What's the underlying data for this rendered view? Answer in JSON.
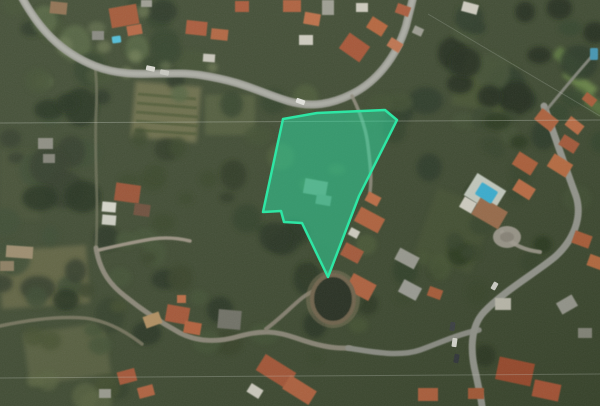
{
  "view": {
    "type": "satellite-map",
    "width": 600,
    "height": 406,
    "base_color": "#39452b",
    "palette": {
      "parcel_fill": "rgba(45,224,164,0.5)",
      "parcel_stroke": "#2ee6a4",
      "road_main": "#9b9c93",
      "road_minor": "#8b8676",
      "roof_terracotta": "#a85331",
      "roof_orange": "#bd6a40",
      "building_white": "#d5d2c5",
      "pool_blue": "#35b2d8",
      "vegetation_dark": "#27331d",
      "field_olive": "#676842"
    },
    "parcel": {
      "points": "283,119 317,113 385,110 397,120 359,196 328,277 302,223 284,222 281,211 263,212",
      "fill": "rgba(45,224,164,0.5)",
      "stroke": "#2ee6a4",
      "stroke_width": 2.5
    },
    "fields": [
      {
        "x": 133,
        "y": 84,
        "w": 66,
        "h": 56,
        "r": 5,
        "c": "#6f7048",
        "o": 0.85
      },
      {
        "x": 205,
        "y": 95,
        "w": 50,
        "h": 40,
        "r": 0,
        "c": "#55603a",
        "o": 0.7
      },
      {
        "x": 0,
        "y": 248,
        "w": 88,
        "h": 58,
        "r": -4,
        "c": "#676842",
        "o": 0.75
      },
      {
        "x": 26,
        "y": 328,
        "w": 82,
        "h": 52,
        "r": -8,
        "c": "#5d6340",
        "o": 0.7
      },
      {
        "x": 0,
        "y": 150,
        "w": 40,
        "h": 70,
        "r": 0,
        "c": "#3f4c2e",
        "o": 0.8
      },
      {
        "x": 424,
        "y": 196,
        "w": 60,
        "h": 70,
        "r": 20,
        "c": "#42502e",
        "o": 0.7
      },
      {
        "x": 455,
        "y": 60,
        "w": 60,
        "h": 50,
        "r": 10,
        "c": "#47552f",
        "o": 0.6
      },
      {
        "x": 552,
        "y": 56,
        "w": 36,
        "h": 12,
        "r": 38,
        "c": "#5d7a3c",
        "o": 0.9
      },
      {
        "x": 562,
        "y": 76,
        "w": 36,
        "h": 12,
        "r": 38,
        "c": "#6d8a46",
        "o": 0.9
      },
      {
        "x": 572,
        "y": 95,
        "w": 36,
        "h": 12,
        "r": 38,
        "c": "#557038",
        "o": 0.9
      }
    ],
    "field_rows": [
      {
        "x1": 138,
        "y1": 94,
        "x2": 196,
        "y2": 99,
        "w": 3,
        "c": "#49552f",
        "o": 0.8
      },
      {
        "x1": 137,
        "y1": 103,
        "x2": 197,
        "y2": 108,
        "w": 3,
        "c": "#49552f",
        "o": 0.8
      },
      {
        "x1": 136,
        "y1": 112,
        "x2": 198,
        "y2": 117,
        "w": 3,
        "c": "#49552f",
        "o": 0.8
      },
      {
        "x1": 136,
        "y1": 121,
        "x2": 198,
        "y2": 126,
        "w": 3,
        "c": "#49552f",
        "o": 0.8
      },
      {
        "x1": 135,
        "y1": 130,
        "x2": 197,
        "y2": 134,
        "w": 3,
        "c": "#49552f",
        "o": 0.8
      }
    ],
    "vegetation": [
      {
        "x": 0,
        "y": 0,
        "w": 240,
        "h": 110,
        "n": 26,
        "rmin": 7,
        "rmax": 18,
        "colors": [
          "#222e1a",
          "#2c3a22",
          "#3a4a2c",
          "#50603a"
        ],
        "o": 0.85
      },
      {
        "x": 0,
        "y": 90,
        "w": 100,
        "h": 220,
        "n": 22,
        "rmin": 8,
        "rmax": 20,
        "colors": [
          "#1e2916",
          "#2a3620",
          "#36452a"
        ],
        "o": 0.85
      },
      {
        "x": 395,
        "y": 0,
        "w": 205,
        "h": 200,
        "n": 30,
        "rmin": 8,
        "rmax": 19,
        "colors": [
          "#1d2815",
          "#263420",
          "#2f3f26",
          "#3c4c2e"
        ],
        "o": 0.9
      },
      {
        "x": 225,
        "y": 95,
        "w": 185,
        "h": 190,
        "n": 18,
        "rmin": 7,
        "rmax": 15,
        "colors": [
          "#2c3a22",
          "#3a4a2c",
          "#465632"
        ],
        "o": 0.8
      },
      {
        "x": 85,
        "y": 225,
        "w": 230,
        "h": 125,
        "n": 22,
        "rmin": 7,
        "rmax": 16,
        "colors": [
          "#242f1c",
          "#303d24",
          "#3e4d2e"
        ],
        "o": 0.85
      },
      {
        "x": 300,
        "y": 250,
        "w": 190,
        "h": 110,
        "n": 14,
        "rmin": 6,
        "rmax": 13,
        "colors": [
          "#27331d",
          "#354326",
          "#42512f"
        ],
        "o": 0.8
      },
      {
        "x": 420,
        "y": 115,
        "w": 130,
        "h": 160,
        "n": 14,
        "rmin": 7,
        "rmax": 14,
        "colors": [
          "#243019",
          "#323f25"
        ],
        "o": 0.8
      },
      {
        "x": 0,
        "y": 300,
        "w": 120,
        "h": 106,
        "n": 10,
        "rmin": 8,
        "rmax": 16,
        "colors": [
          "#2c3820",
          "#3c4828",
          "#55603a"
        ],
        "o": 0.7
      },
      {
        "x": 120,
        "y": 130,
        "w": 120,
        "h": 110,
        "n": 12,
        "rmin": 6,
        "rmax": 14,
        "colors": [
          "#26321c",
          "#334024"
        ],
        "o": 0.8
      },
      {
        "x": 40,
        "y": 0,
        "w": 180,
        "h": 80,
        "n": 8,
        "rmin": 4,
        "rmax": 9,
        "colors": [
          "#6a7850",
          "#7a8658"
        ],
        "o": 0.5
      }
    ],
    "roads": [
      {
        "d": "M 95 66 C 97 82 97 98 96 114 C 95 138 96 170 97 200 C 97 220 97 235 96 248",
        "w": 3,
        "c": "#6f7258",
        "o": 0.7
      },
      {
        "d": "M 0 326 C 28 320 56 316 84 318 C 104 320 124 330 142 344",
        "w": 3.5,
        "c": "#7f7a64",
        "o": 0.8
      },
      {
        "d": "M 96 248 C 99 266 106 280 120 292 C 140 309 160 322 180 333 C 200 343 220 342 240 336 C 262 330 276 331 296 338 C 316 345 332 349 350 348",
        "w": 5,
        "c": "#8b8676",
        "o": 1
      },
      {
        "d": "M 266 329 C 282 317 292 306 302 298 C 312 290 326 286 338 285",
        "w": 4,
        "c": "#857f6e",
        "o": 1
      },
      {
        "d": "M 99 250 C 116 246 134 242 152 239 C 166 237 178 238 190 241",
        "w": 3.5,
        "c": "#9a9180",
        "o": 1
      },
      {
        "d": "M 479 330 C 458 334 437 344 420 350 C 400 357 372 352 348 348",
        "w": 5.5,
        "c": "#8f9087",
        "o": 1
      },
      {
        "d": "M 544 106 C 550 122 562 158 576 196 C 583 218 573 240 556 256 C 540 270 505 290 484 312 C 470 327 470 352 476 375 C 479 389 481 398 482 406",
        "w": 7,
        "c": "#97988f",
        "o": 1
      },
      {
        "d": "M 540 118 C 558 96 576 74 594 54",
        "w": 3,
        "c": "#8a8b80",
        "o": 0.9
      },
      {
        "d": "M 20 -6 C 38 28 60 52 95 66 C 130 80 165 70 200 75 C 245 82 258 92 288 101 C 312 108 332 104 352 94 C 376 82 396 58 406 26 L 414 -6",
        "w": 8,
        "c": "#9b9c93",
        "o": 1
      },
      {
        "d": "M 20 -6 C 38 28 60 52 95 66 C 130 80 165 70 200 75 C 245 82 258 92 288 101 C 312 108 332 104 352 94 C 376 82 396 58 406 26 L 414 -6",
        "w": 4,
        "c": "#b2b3aa",
        "o": 0.7
      },
      {
        "d": "M 352 96 C 360 112 366 128 368 146 C 370 162 372 178 370 192",
        "w": 3.5,
        "c": "#8f8a7a",
        "o": 0.9
      },
      {
        "d": "M 540 252 C 524 250 510 244 502 232",
        "w": 4,
        "c": "#a39d90",
        "o": 0.9
      }
    ],
    "ellipses": [
      {
        "cx": 507,
        "cy": 237,
        "rx": 14,
        "ry": 11,
        "c": "#a8a296",
        "o": 0.9
      },
      {
        "cx": 507,
        "cy": 237,
        "rx": 7,
        "ry": 5,
        "c": "#8a8478",
        "o": 0.9
      },
      {
        "cx": 333,
        "cy": 299,
        "rx": 27,
        "ry": 29,
        "c": "#8a7d5f",
        "o": 0.45
      }
    ],
    "buildings": [
      {
        "x": 110,
        "y": 6,
        "w": 28,
        "h": 20,
        "r": -10,
        "c": "#a0512e"
      },
      {
        "x": 127,
        "y": 25,
        "w": 15,
        "h": 10,
        "r": -10,
        "c": "#b3613a"
      },
      {
        "x": 50,
        "y": 2,
        "w": 17,
        "h": 12,
        "r": 6,
        "c": "#8a6a4a"
      },
      {
        "x": 92,
        "y": 31,
        "w": 12,
        "h": 9,
        "r": 0,
        "c": "#83837a"
      },
      {
        "x": 141,
        "y": 0,
        "w": 11,
        "h": 7,
        "r": 0,
        "c": "#9a9a8e"
      },
      {
        "x": 186,
        "y": 21,
        "w": 21,
        "h": 14,
        "r": 6,
        "c": "#a85331"
      },
      {
        "x": 211,
        "y": 29,
        "w": 17,
        "h": 11,
        "r": 6,
        "c": "#b05f39"
      },
      {
        "x": 235,
        "y": 1,
        "w": 14,
        "h": 11,
        "r": 0,
        "c": "#a85331"
      },
      {
        "x": 203,
        "y": 54,
        "w": 12,
        "h": 8,
        "r": 4,
        "c": "#c9c6ba"
      },
      {
        "x": 283,
        "y": 0,
        "w": 18,
        "h": 12,
        "r": 0,
        "c": "#ad5a36"
      },
      {
        "x": 304,
        "y": 13,
        "w": 16,
        "h": 12,
        "r": 10,
        "c": "#bd6a40"
      },
      {
        "x": 299,
        "y": 35,
        "w": 14,
        "h": 10,
        "r": 0,
        "c": "#d0cdc0"
      },
      {
        "x": 322,
        "y": 0,
        "w": 12,
        "h": 15,
        "r": 0,
        "c": "#9c9c90"
      },
      {
        "x": 342,
        "y": 38,
        "w": 25,
        "h": 19,
        "r": 35,
        "c": "#a64f2f"
      },
      {
        "x": 368,
        "y": 20,
        "w": 18,
        "h": 13,
        "r": 32,
        "c": "#b66036"
      },
      {
        "x": 388,
        "y": 40,
        "w": 14,
        "h": 10,
        "r": 32,
        "c": "#c07048"
      },
      {
        "x": 356,
        "y": 3,
        "w": 12,
        "h": 9,
        "r": 0,
        "c": "#cfccbe"
      },
      {
        "x": 396,
        "y": 5,
        "w": 14,
        "h": 10,
        "r": 20,
        "c": "#ab5634"
      },
      {
        "x": 413,
        "y": 27,
        "w": 10,
        "h": 8,
        "r": 25,
        "c": "#9c9c90"
      },
      {
        "x": 462,
        "y": 3,
        "w": 16,
        "h": 10,
        "r": 15,
        "c": "#d2cfc2"
      },
      {
        "x": 536,
        "y": 113,
        "w": 21,
        "h": 14,
        "r": 38,
        "c": "#b25e38"
      },
      {
        "x": 566,
        "y": 120,
        "w": 17,
        "h": 11,
        "r": 38,
        "c": "#c06a40"
      },
      {
        "x": 583,
        "y": 95,
        "w": 13,
        "h": 9,
        "r": 38,
        "c": "#ad5a36"
      },
      {
        "x": 514,
        "y": 156,
        "w": 22,
        "h": 15,
        "r": 32,
        "c": "#b05c36"
      },
      {
        "x": 549,
        "y": 158,
        "w": 22,
        "h": 15,
        "r": 32,
        "c": "#bd6a3e"
      },
      {
        "x": 560,
        "y": 138,
        "w": 18,
        "h": 12,
        "r": 32,
        "c": "#a85634"
      },
      {
        "x": 514,
        "y": 183,
        "w": 20,
        "h": 13,
        "r": 32,
        "c": "#c06a40"
      },
      {
        "x": 573,
        "y": 233,
        "w": 18,
        "h": 13,
        "r": 20,
        "c": "#b05c36"
      },
      {
        "x": 588,
        "y": 256,
        "w": 15,
        "h": 12,
        "r": 20,
        "c": "#bd6a3e"
      },
      {
        "x": 468,
        "y": 180,
        "w": 34,
        "h": 26,
        "r": 32,
        "c": "#c9cfc3"
      },
      {
        "x": 474,
        "y": 203,
        "w": 31,
        "h": 20,
        "r": 30,
        "c": "#9c6a46"
      },
      {
        "x": 461,
        "y": 199,
        "w": 14,
        "h": 12,
        "r": 30,
        "c": "#d8d5c8"
      },
      {
        "x": 356,
        "y": 212,
        "w": 27,
        "h": 16,
        "r": 28,
        "c": "#b45e38"
      },
      {
        "x": 342,
        "y": 246,
        "w": 20,
        "h": 14,
        "r": 28,
        "c": "#a85634"
      },
      {
        "x": 348,
        "y": 278,
        "w": 26,
        "h": 18,
        "r": 28,
        "c": "#b5603a"
      },
      {
        "x": 396,
        "y": 252,
        "w": 22,
        "h": 13,
        "r": 28,
        "c": "#9c9c92"
      },
      {
        "x": 400,
        "y": 283,
        "w": 20,
        "h": 14,
        "r": 28,
        "c": "#a0a098"
      },
      {
        "x": 349,
        "y": 229,
        "w": 10,
        "h": 8,
        "r": 28,
        "c": "#d5d2c5"
      },
      {
        "x": 366,
        "y": 194,
        "w": 14,
        "h": 10,
        "r": 28,
        "c": "#c06a40"
      },
      {
        "x": 115,
        "y": 184,
        "w": 25,
        "h": 18,
        "r": 8,
        "c": "#9a4e2f"
      },
      {
        "x": 102,
        "y": 202,
        "w": 14,
        "h": 10,
        "r": 5,
        "c": "#d8d8cc"
      },
      {
        "x": 102,
        "y": 215,
        "w": 14,
        "h": 10,
        "r": 5,
        "c": "#d0d0c4"
      },
      {
        "x": 134,
        "y": 204,
        "w": 16,
        "h": 12,
        "r": 8,
        "c": "#6b4a35"
      },
      {
        "x": 38,
        "y": 138,
        "w": 15,
        "h": 11,
        "r": 0,
        "c": "#8a8a7e"
      },
      {
        "x": 43,
        "y": 154,
        "w": 12,
        "h": 9,
        "r": 0,
        "c": "#7e7e72"
      },
      {
        "x": 6,
        "y": 246,
        "w": 27,
        "h": 12,
        "r": 4,
        "c": "#9c8a6a"
      },
      {
        "x": 0,
        "y": 261,
        "w": 14,
        "h": 10,
        "r": 0,
        "c": "#8a7a5c"
      },
      {
        "x": 144,
        "y": 314,
        "w": 17,
        "h": 12,
        "r": -20,
        "c": "#b5905f"
      },
      {
        "x": 166,
        "y": 306,
        "w": 23,
        "h": 17,
        "r": 10,
        "c": "#a85230"
      },
      {
        "x": 184,
        "y": 322,
        "w": 17,
        "h": 12,
        "r": 10,
        "c": "#b85e38"
      },
      {
        "x": 177,
        "y": 295,
        "w": 9,
        "h": 8,
        "r": 0,
        "c": "#c06a40"
      },
      {
        "x": 218,
        "y": 310,
        "w": 23,
        "h": 19,
        "r": 5,
        "c": "#6f6f65"
      },
      {
        "x": 258,
        "y": 362,
        "w": 36,
        "h": 19,
        "r": 32,
        "c": "#a85230"
      },
      {
        "x": 284,
        "y": 382,
        "w": 31,
        "h": 16,
        "r": 32,
        "c": "#b5603a"
      },
      {
        "x": 248,
        "y": 386,
        "w": 14,
        "h": 10,
        "r": 32,
        "c": "#d5d2c5"
      },
      {
        "x": 118,
        "y": 370,
        "w": 18,
        "h": 13,
        "r": -15,
        "c": "#a85230"
      },
      {
        "x": 138,
        "y": 386,
        "w": 16,
        "h": 11,
        "r": -15,
        "c": "#b5603a"
      },
      {
        "x": 99,
        "y": 389,
        "w": 12,
        "h": 9,
        "r": 0,
        "c": "#9c9c90"
      },
      {
        "x": 497,
        "y": 360,
        "w": 36,
        "h": 23,
        "r": 12,
        "c": "#a0492c"
      },
      {
        "x": 533,
        "y": 382,
        "w": 27,
        "h": 17,
        "r": 12,
        "c": "#b05434"
      },
      {
        "x": 468,
        "y": 388,
        "w": 16,
        "h": 11,
        "r": 0,
        "c": "#ad5a36"
      },
      {
        "x": 495,
        "y": 298,
        "w": 16,
        "h": 12,
        "r": 0,
        "c": "#c3c0b2"
      },
      {
        "x": 558,
        "y": 298,
        "w": 18,
        "h": 13,
        "r": -30,
        "c": "#9c9c92"
      },
      {
        "x": 578,
        "y": 328,
        "w": 14,
        "h": 10,
        "r": 0,
        "c": "#8a8a7e"
      },
      {
        "x": 428,
        "y": 288,
        "w": 14,
        "h": 10,
        "r": 20,
        "c": "#ad5a36"
      },
      {
        "x": 418,
        "y": 388,
        "w": 20,
        "h": 13,
        "r": 0,
        "c": "#b5603a"
      },
      {
        "x": 304,
        "y": 180,
        "w": 23,
        "h": 15,
        "r": 10,
        "c": "#7f8877"
      },
      {
        "x": 316,
        "y": 195,
        "w": 15,
        "h": 10,
        "r": 10,
        "c": "#74816f"
      }
    ],
    "pools": [
      {
        "x": 477,
        "y": 186,
        "w": 19,
        "h": 14,
        "r": 32,
        "c": "#35b2d8"
      },
      {
        "x": 112,
        "y": 36,
        "w": 9,
        "h": 7,
        "r": -8,
        "c": "#49bcd8"
      },
      {
        "x": 590,
        "y": 48,
        "w": 8,
        "h": 12,
        "r": 0,
        "c": "#3f98b8"
      }
    ],
    "ring": {
      "cx": 333,
      "cy": 299,
      "rx": 21,
      "ry": 24,
      "fill": "#232a1b",
      "stroke": "#6f624a",
      "sw": 4
    },
    "cars": [
      {
        "x": 296,
        "y": 99,
        "w": 9,
        "h": 5,
        "r": 20,
        "c": "#e8e8e2"
      },
      {
        "x": 146,
        "y": 66,
        "w": 9,
        "h": 5,
        "r": 12,
        "c": "#dadad2"
      },
      {
        "x": 160,
        "y": 70,
        "w": 9,
        "h": 5,
        "r": 12,
        "c": "#c8c8c0"
      },
      {
        "x": 450,
        "y": 322,
        "w": 5,
        "h": 9,
        "r": 8,
        "c": "#383c40"
      },
      {
        "x": 452,
        "y": 338,
        "w": 5,
        "h": 9,
        "r": 8,
        "c": "#e2e2da"
      },
      {
        "x": 454,
        "y": 354,
        "w": 5,
        "h": 9,
        "r": 10,
        "c": "#2e3238"
      },
      {
        "x": 492,
        "y": 282,
        "w": 5,
        "h": 8,
        "r": 30,
        "c": "#d8d8d0"
      }
    ],
    "power_lines": [
      {
        "x1": 0,
        "y1": 123,
        "x2": 600,
        "y2": 120,
        "c": "#d8dcd4",
        "o": 0.3,
        "w": 1
      },
      {
        "x1": 0,
        "y1": 378,
        "x2": 600,
        "y2": 374,
        "c": "#d8dcd4",
        "o": 0.28,
        "w": 1
      },
      {
        "x1": 428,
        "y1": 14,
        "x2": 600,
        "y2": 116,
        "c": "#cfd4cc",
        "o": 0.22,
        "w": 1
      }
    ]
  }
}
